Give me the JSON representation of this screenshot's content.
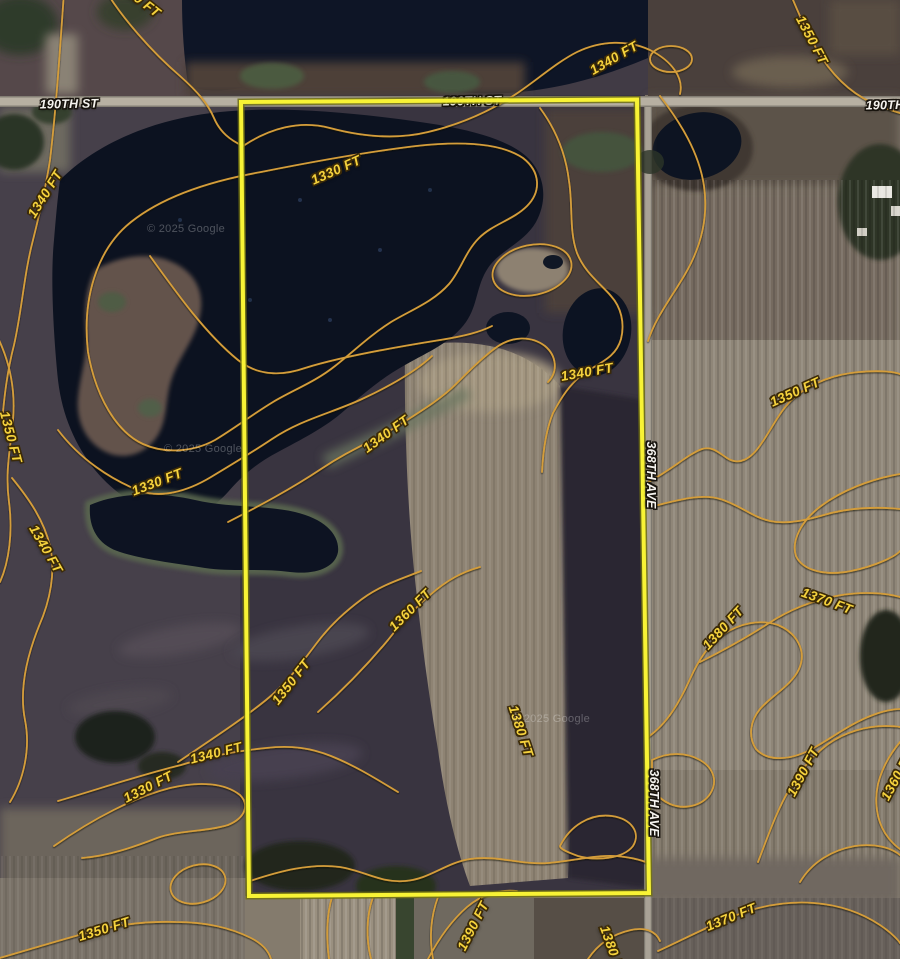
{
  "map": {
    "type": "satellite-with-contours",
    "attribution": "© 2025 Google",
    "units": "FT",
    "contour_levels": [
      1330,
      1340,
      1350,
      1360,
      1370,
      1380,
      1390
    ],
    "roads": {
      "east_west": "190TH ST",
      "north_south": "368TH AVE"
    },
    "colors": {
      "parcel_boundary": "#f8f335",
      "contour_line": "#d49d3a",
      "contour_label": "#f5d23d",
      "road_label": "#f5f3ee",
      "water": "#0c1220",
      "field_light": "#8e8373"
    }
  },
  "labels": [
    {
      "t": "1330 FT",
      "x": 138,
      "y": -2,
      "r": 38,
      "type": "elev"
    },
    {
      "t": "1340 FT",
      "x": 614,
      "y": 58,
      "r": -30,
      "type": "elev"
    },
    {
      "t": "1350 FT",
      "x": 812,
      "y": 40,
      "r": 62,
      "type": "elev"
    },
    {
      "t": "1330 FT",
      "x": 336,
      "y": 170,
      "r": -24,
      "type": "elev"
    },
    {
      "t": "1340 FT",
      "x": 45,
      "y": 194,
      "r": -58,
      "type": "elev"
    },
    {
      "t": "1350 FT",
      "x": 11,
      "y": 437,
      "r": 75,
      "type": "elev"
    },
    {
      "t": "1330 FT",
      "x": 157,
      "y": 482,
      "r": -21,
      "type": "elev"
    },
    {
      "t": "1340 FT",
      "x": 386,
      "y": 434,
      "r": -36,
      "type": "elev"
    },
    {
      "t": "1340 FT",
      "x": 587,
      "y": 372,
      "r": -10,
      "type": "elev"
    },
    {
      "t": "1350 FT",
      "x": 795,
      "y": 392,
      "r": -24,
      "type": "elev"
    },
    {
      "t": "1340 FT",
      "x": 46,
      "y": 549,
      "r": 60,
      "type": "elev"
    },
    {
      "t": "1360 FT",
      "x": 410,
      "y": 610,
      "r": -45,
      "type": "elev"
    },
    {
      "t": "1370 FT",
      "x": 827,
      "y": 601,
      "r": 20,
      "type": "elev"
    },
    {
      "t": "1380 FT",
      "x": 723,
      "y": 628,
      "r": -47,
      "type": "elev"
    },
    {
      "t": "1350 FT",
      "x": 291,
      "y": 682,
      "r": -52,
      "type": "elev"
    },
    {
      "t": "1380 FT",
      "x": 521,
      "y": 731,
      "r": 72,
      "type": "elev"
    },
    {
      "t": "1340 FT",
      "x": 216,
      "y": 753,
      "r": -14,
      "type": "elev"
    },
    {
      "t": "1330 FT",
      "x": 148,
      "y": 787,
      "r": -27,
      "type": "elev"
    },
    {
      "t": "1390 FT",
      "x": 803,
      "y": 772,
      "r": -62,
      "type": "elev"
    },
    {
      "t": "1360 FT",
      "x": 897,
      "y": 776,
      "r": -62,
      "type": "elev"
    },
    {
      "t": "1350 FT",
      "x": 104,
      "y": 929,
      "r": -17,
      "type": "elev"
    },
    {
      "t": "1390 FT",
      "x": 473,
      "y": 926,
      "r": -63,
      "type": "elev"
    },
    {
      "t": "1370 FT",
      "x": 731,
      "y": 917,
      "r": -22,
      "type": "elev"
    },
    {
      "t": "1380 FT",
      "x": 613,
      "y": 951,
      "r": 70,
      "type": "elev"
    },
    {
      "t": "190TH ST",
      "x": 69,
      "y": 104,
      "r": -1,
      "type": "road"
    },
    {
      "t": "190TH ST",
      "x": 472,
      "y": 101,
      "r": -1,
      "type": "road",
      "layer": "under"
    },
    {
      "t": "190TH ST",
      "x": 895,
      "y": 105,
      "r": -1,
      "type": "road"
    },
    {
      "t": "368TH AVE",
      "x": 651,
      "y": 475,
      "r": 90,
      "type": "road"
    },
    {
      "t": "368TH AVE",
      "x": 654,
      "y": 803,
      "r": 90,
      "type": "road"
    },
    {
      "t": "© 2025 Google",
      "x": 186,
      "y": 229,
      "r": 0,
      "type": "wm"
    },
    {
      "t": "© 2025 Google",
      "x": 203,
      "y": 449,
      "r": 0,
      "type": "wm"
    },
    {
      "t": "© 2025 Google",
      "x": 551,
      "y": 719,
      "r": 0,
      "type": "wm"
    }
  ]
}
